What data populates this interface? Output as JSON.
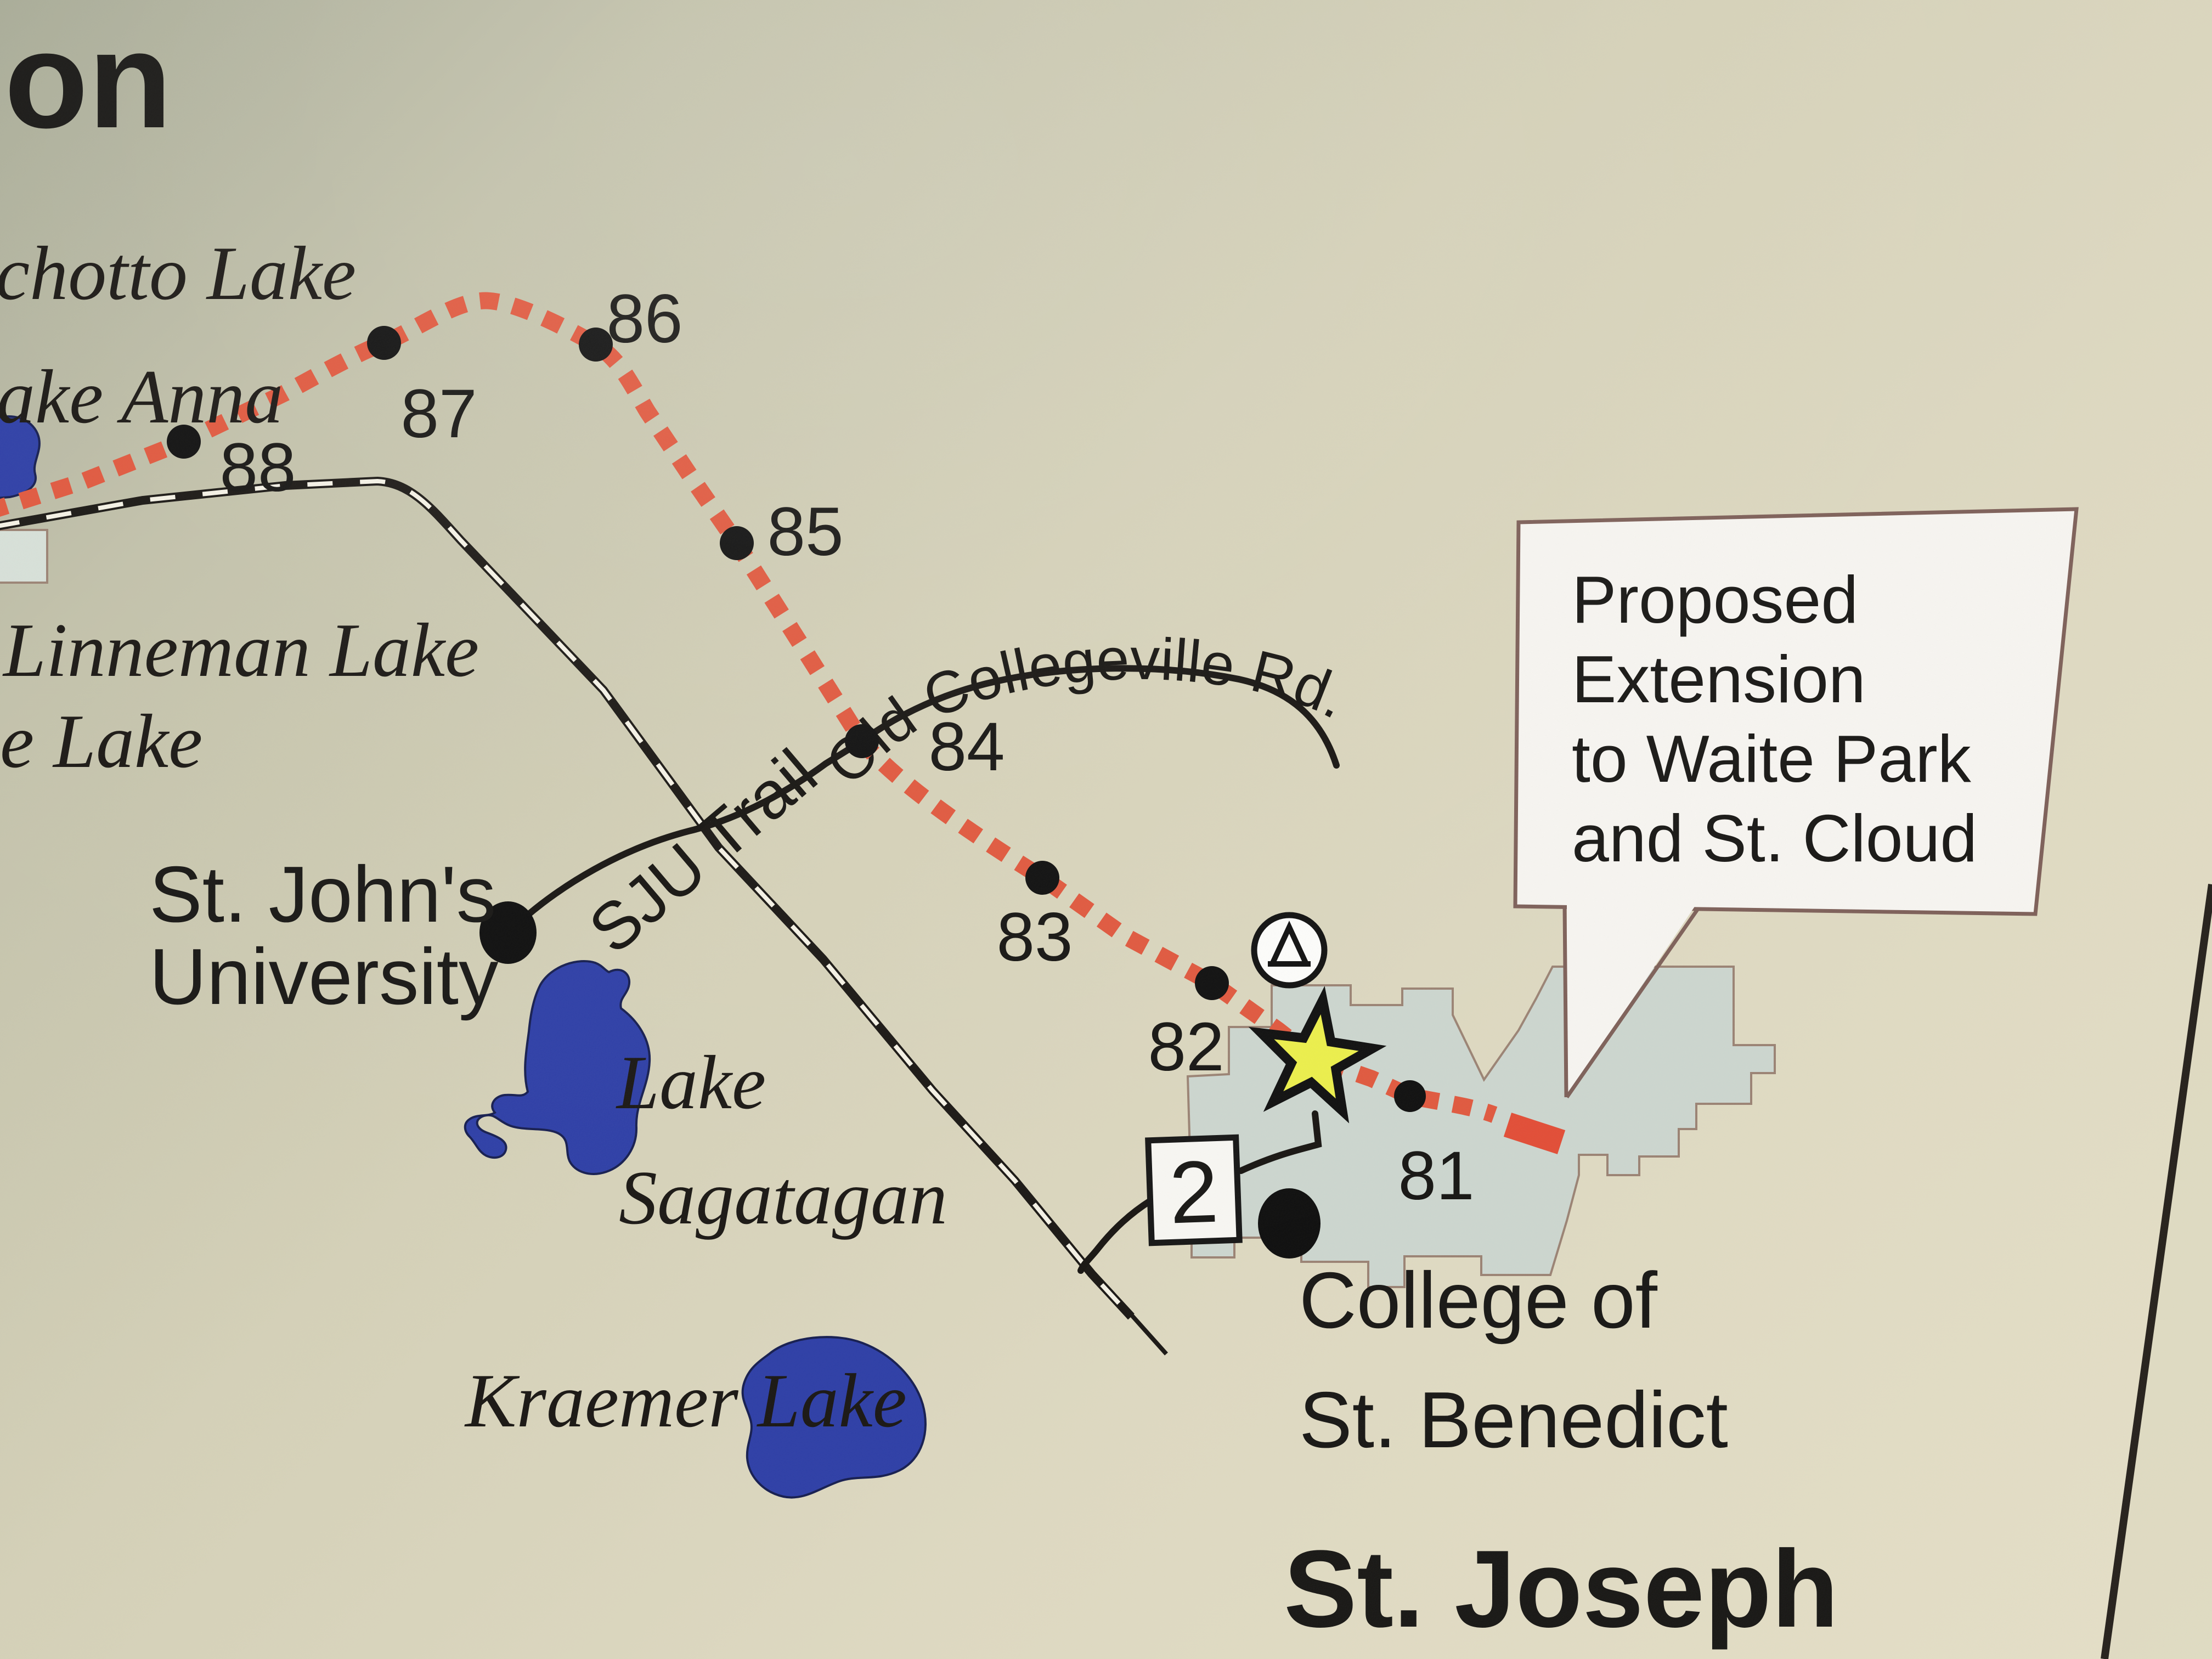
{
  "map_title_fragment": "on",
  "labels": {
    "lakes": {
      "achotto": "chotto Lake",
      "anna": "ake Anna",
      "linneman": "Linneman Lake",
      "partial_e": "e Lake",
      "sagatagan_line1": "Lake",
      "sagatagan_line2": "Sagatagan",
      "kraemer": "Kraemer Lake"
    },
    "places": {
      "sju_line1": "St. John's",
      "sju_line2": "University",
      "csb_line1": "College of",
      "csb_line2": "St. Benedict",
      "st_joseph": "St. Joseph"
    },
    "roads": {
      "old_collegeville": "Old Collegeville Rd.",
      "sju_trail": "SJU Trail",
      "highway_2": "2"
    },
    "callout": {
      "line1": "Proposed",
      "line2": "Extension",
      "line3": "to Waite Park",
      "line4": "and St. Cloud"
    }
  },
  "trail": {
    "name_context": "Lake Wobegon Trail mile markers",
    "mile_markers": [
      {
        "label": "88"
      },
      {
        "label": "87"
      },
      {
        "label": "86"
      },
      {
        "label": "85"
      },
      {
        "label": "84"
      },
      {
        "label": "83"
      },
      {
        "label": "82"
      },
      {
        "label": "81"
      }
    ]
  },
  "colors": {
    "trail_red": "#e0573d",
    "trail_red_solid": "#e24c35",
    "lake_blue": "#2c3da6",
    "urban_gray": "#ccd6cf",
    "urban_border": "#9a8273",
    "callout_fill": "#f7f5f1",
    "callout_border": "#7d5f58",
    "railroad_black": "#181512",
    "star_yellow": "#ecef4a",
    "marker_white": "#f8f7f3"
  }
}
